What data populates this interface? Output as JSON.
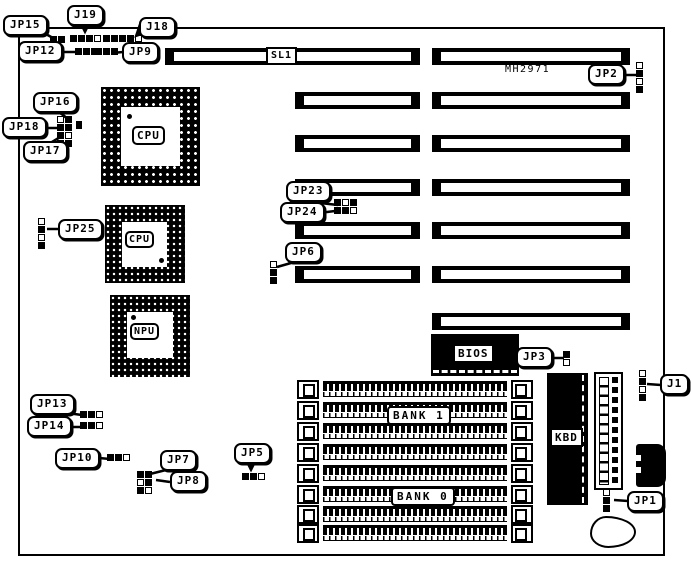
{
  "board": {
    "model_text": "MH2971",
    "slot_label": "SL1",
    "chip_labels": {
      "cpu_main": "CPU",
      "cpu_alt": "CPU",
      "npu": "NPU",
      "bios": "BIOS",
      "kbd": "KBD"
    },
    "bank_labels": {
      "bank1": "BANK 1",
      "bank0": "BANK 0"
    },
    "jumper_labels": {
      "jp15": "JP15",
      "j19": "J19",
      "j18": "J18",
      "jp12": "JP12",
      "jp9": "JP9",
      "jp16": "JP16",
      "jp18": "JP18",
      "jp17": "JP17",
      "jp25": "JP25",
      "jp23": "JP23",
      "jp24": "JP24",
      "jp6": "JP6",
      "jp2": "JP2",
      "jp3": "JP3",
      "j1": "J1",
      "jp13": "JP13",
      "jp14": "JP14",
      "jp10": "JP10",
      "jp7": "JP7",
      "jp8": "JP8",
      "jp5": "JP5",
      "jp1": "JP1"
    },
    "colors": {
      "line": "#000000",
      "background": "#ffffff"
    }
  }
}
